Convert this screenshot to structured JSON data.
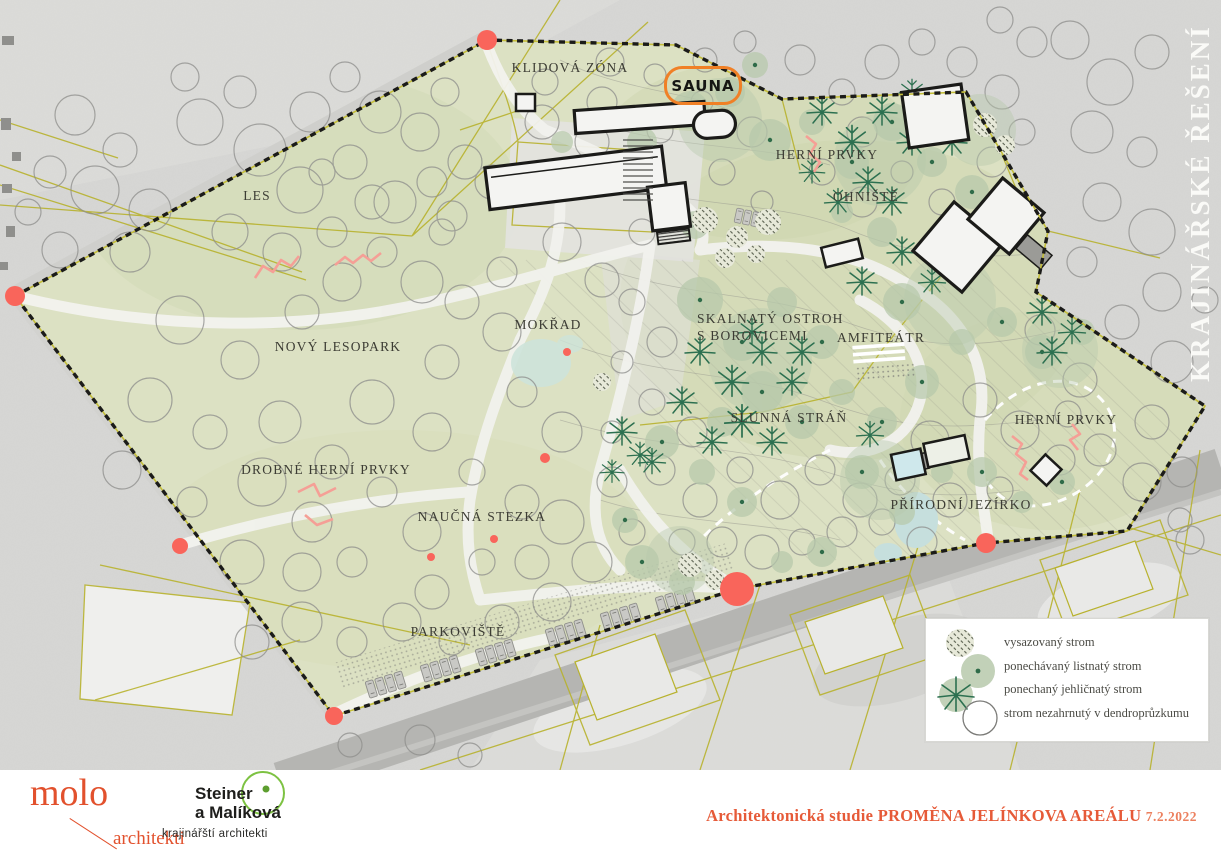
{
  "side_title": "KRAJINÁŘSKÉ ŘEŠENÍ",
  "map": {
    "labels": {
      "klidova_zona": "KLIDOVÁ ZÓNA",
      "sauna": "SAUNA",
      "herni_prvky_top": "HERNÍ PRVKY",
      "ohniste": "OHNIŠTĚ",
      "les": "LES",
      "novy_lesopark": "NOVÝ LESOPARK",
      "mokrad": "MOKŘAD",
      "skalnaty_ostroh_line1": "SKALNATÝ OSTROH",
      "skalnaty_ostroh_line2": "S BOROVICEMI",
      "amfiteatr": "AMFITEÁTR",
      "slunna_stran": "SLUNNÁ STRÁŇ",
      "drobne_herni_prvky": "DROBNÉ HERNÍ PRVKY",
      "naucna_stezka": "NAUČNÁ STEZKA",
      "herni_prvky_right": "HERNÍ PRVKY",
      "prirodni_jezirko": "PŘÍRODNÍ JEZÍRKO",
      "parkoviste": "PARKOVIŠTĚ"
    }
  },
  "legend": {
    "items": [
      {
        "icon": "planted-tree-icon",
        "label": "vysazovaný strom"
      },
      {
        "icon": "kept-deciduous-tree-icon",
        "label": "ponechávaný listnatý strom"
      },
      {
        "icon": "kept-coniferous-tree-icon",
        "label": "ponechaný jehličnatý strom"
      },
      {
        "icon": "unsurveyed-tree-icon",
        "label": "strom nezahrnutý v dendroprůzkumu"
      }
    ]
  },
  "footer": {
    "molo": {
      "name": "molo",
      "subtitle": "architekti"
    },
    "steiner": {
      "line1": "Steiner",
      "line2": "a Malíková",
      "subtitle": "krajinářští architekti"
    },
    "project": {
      "prefix": "Architektonická studie ",
      "name": "PROMĚNA JELÍNKOVA AREÁLU",
      "date": "7.2.2022"
    }
  },
  "colors": {
    "sauna_orange": "#f08026",
    "entrance_red": "#f9655b",
    "molo_red": "#e2512d",
    "title_red": "#e65a38",
    "steiner_green": "#7dc242",
    "park_green": "#dce1c3",
    "conifer_green": "#2c7050"
  }
}
